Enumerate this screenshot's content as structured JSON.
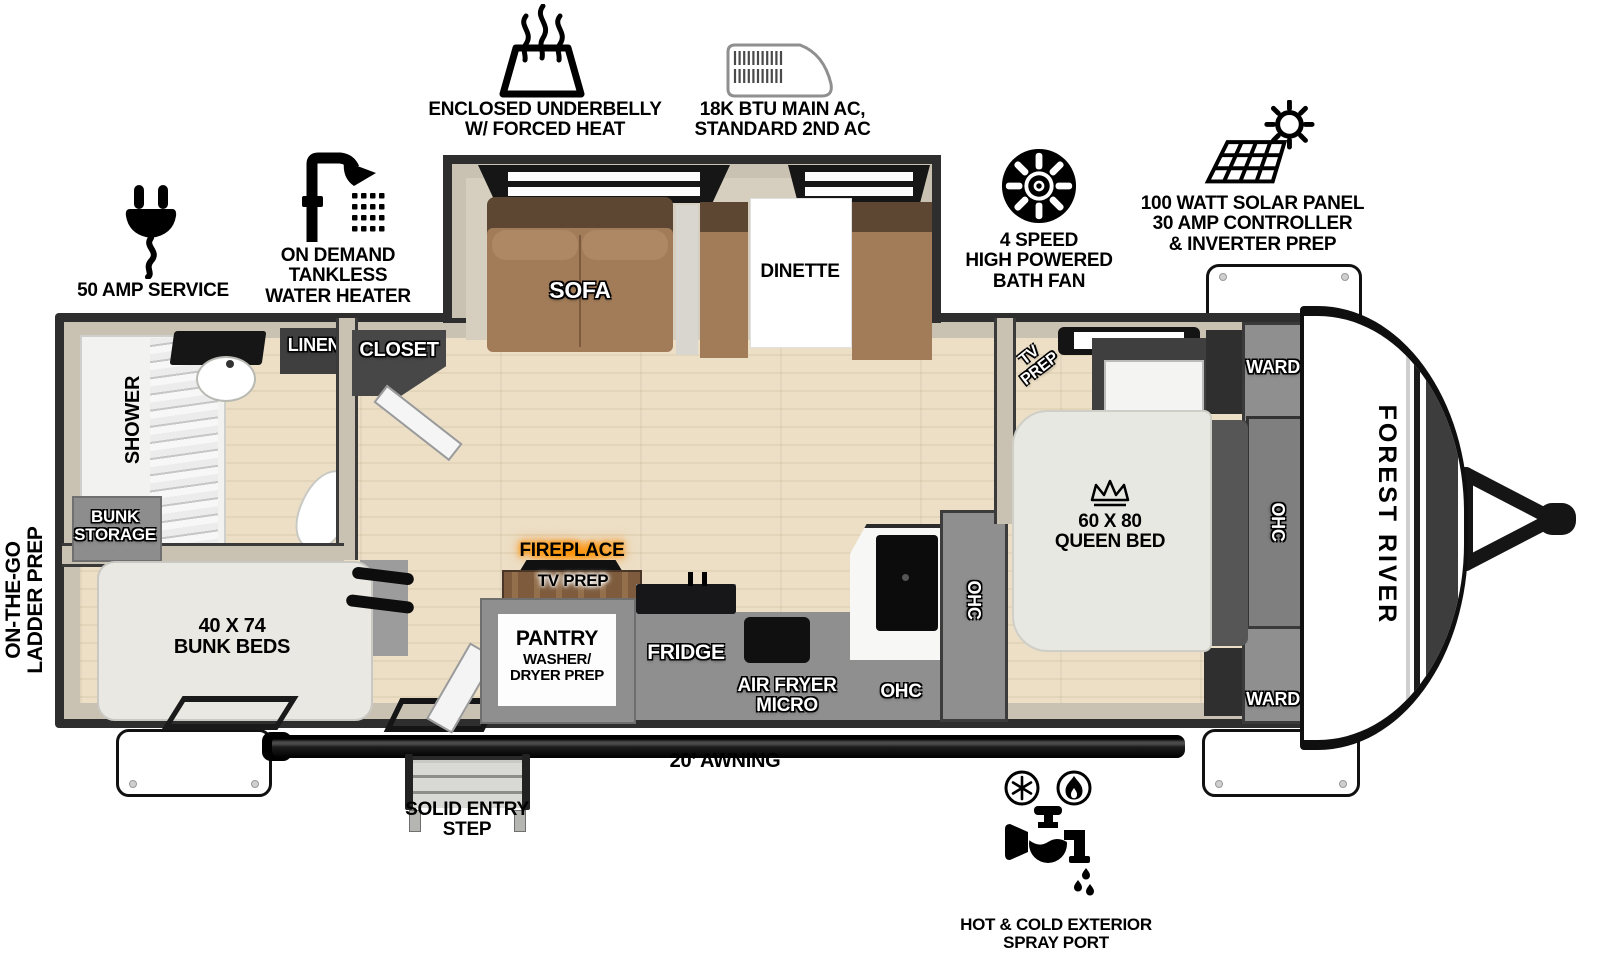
{
  "brand": "FOREST RIVER",
  "features": {
    "underbelly": "ENCLOSED UNDERBELLY\nW/ FORCED HEAT",
    "ac": "18K BTU MAIN AC,\nSTANDARD 2ND AC",
    "bath_fan": "4 SPEED\nHIGH POWERED\nBATH FAN",
    "solar": "100 WATT SOLAR PANEL\n30 AMP CONTROLLER\n& INVERTER PREP",
    "amp_service": "50 AMP SERVICE",
    "water_heater": "ON DEMAND\nTANKLESS\nWATER HEATER",
    "ladder_prep": "ON-THE-GO\nLADDER PREP",
    "awning": "20’ AWNING",
    "entry_step": "SOLID ENTRY\nSTEP",
    "spray_port": "HOT & COLD EXTERIOR\nSPRAY PORT"
  },
  "rooms": {
    "sofa": "SOFA",
    "dinette": "DINETTE",
    "linen": "LINEN",
    "closet": "CLOSET",
    "shower": "SHOWER",
    "bunk_storage": "BUNK\nSTORAGE",
    "bunk_beds": "40 X 74\nBUNK BEDS",
    "fireplace": "FIREPLACE",
    "tv_prep_living": "TV PREP",
    "pantry_title": "PANTRY",
    "pantry_sub": "WASHER/\nDRYER PREP",
    "fridge": "FRIDGE",
    "air_fryer_micro": "AIR FRYER\nMICRO",
    "ohc_kitchen": "OHC",
    "ohc_kitchen_wall": "OHC",
    "tv_prep_bedroom": "TV\nPREP",
    "ward_front": "WARD",
    "ward_rear": "WARD",
    "queen_bed": "60 X 80\nQUEEN BED",
    "ohc_bedroom": "OHC"
  },
  "colors": {
    "wall_dark": "#2e2e2e",
    "wall_beige": "#c9c2b2",
    "floor_wood": "#e8dcc2",
    "cabinet_gray": "#8f8f8f",
    "sofa_brown": "#a27c59",
    "sofa_brown_dark": "#5d4632",
    "fireplace_glow": "#ff8c00"
  }
}
